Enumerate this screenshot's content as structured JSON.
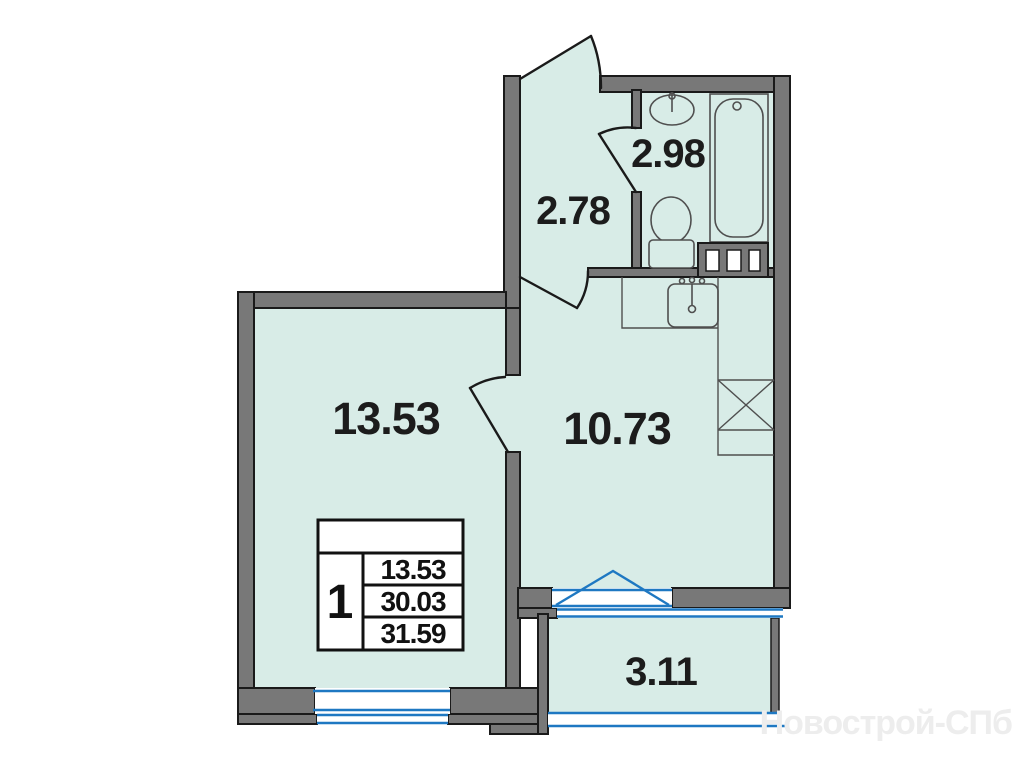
{
  "plan": {
    "title": "one-room apartment floor plan",
    "rooms": [
      {
        "id": "living-room",
        "area_label": "13.53"
      },
      {
        "id": "kitchen",
        "area_label": "10.73"
      },
      {
        "id": "hallway",
        "area_label": "2.78"
      },
      {
        "id": "bathroom",
        "area_label": "2.98"
      },
      {
        "id": "balcony",
        "area_label": "3.11"
      }
    ],
    "info_box": {
      "rooms_count": "1",
      "living_area": "13.53",
      "area": "30.03",
      "total_area": "31.59"
    },
    "fixtures": [
      "bathroom-sink",
      "bathtub",
      "toilet",
      "washing-machine",
      "kitchen-sink",
      "stove"
    ],
    "watermark": "Новострой-СПб",
    "colors": {
      "room_fill": "#d8ece7",
      "wall": "#787878",
      "outline": "#1a1a1a",
      "window_blue": "#1e78c2",
      "fixture": "#4f4f4f",
      "text": "#1c1c1c",
      "watermark": "#ededed"
    }
  }
}
